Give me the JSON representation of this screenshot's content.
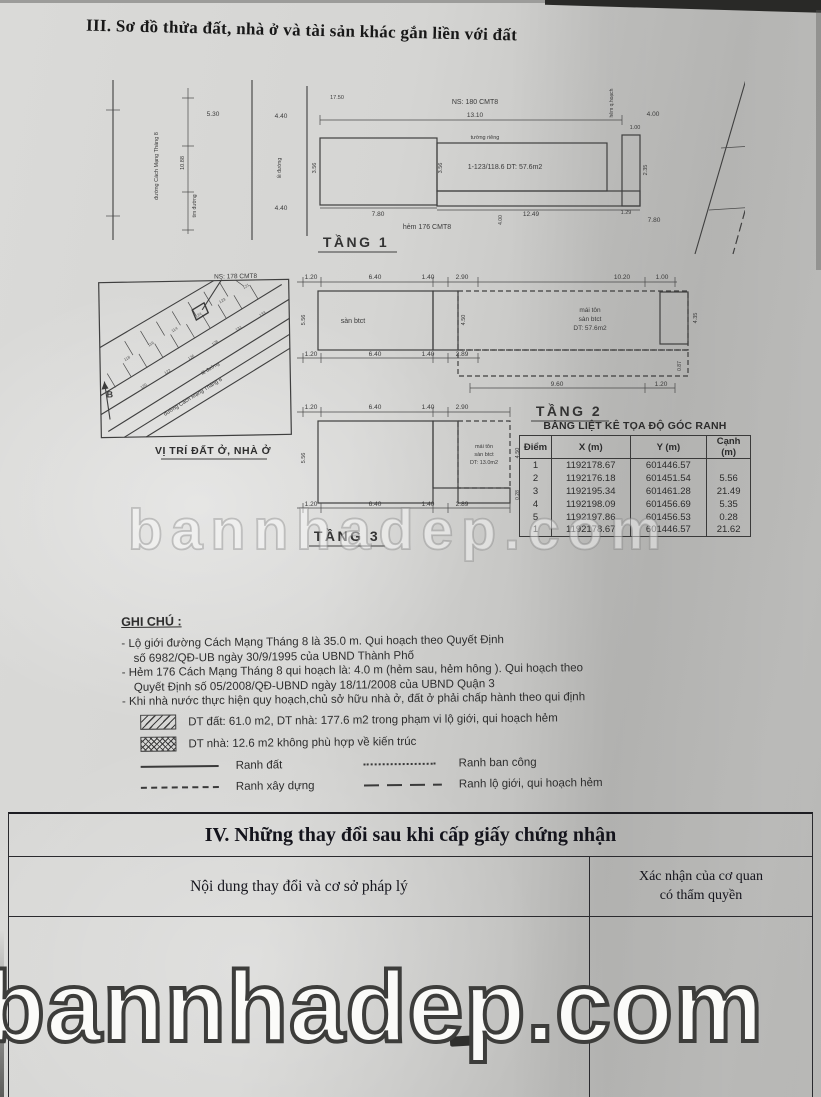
{
  "title3": "III. Sơ đồ thửa đất, nhà ở và tài sản khác gắn liền với đất",
  "watermark": {
    "text": "bannhadep.com"
  },
  "floor1": {
    "label": "TẦNG 1",
    "street": "đường Cách Mạng Tháng 8",
    "tim_duong": "tim đường",
    "le_duong": "lề đường",
    "hem_qh": "hẻm q.hoạch",
    "ns": "NS: 180 CMT8",
    "tuong_rieng": "tường riêng",
    "plot": "1-123/118.6  DT: 57.6m2",
    "hem": "hẻm 176 CMT8",
    "dims": {
      "d530": "5.30",
      "d1088": "10.88",
      "d440a": "4.40",
      "d440b": "4.40",
      "d1750": "17.50",
      "d1310": "13.10",
      "d400": "4.00",
      "d100": "1.00",
      "d356a": "3.56",
      "d356b": "3.56",
      "d235": "2.35",
      "d780a": "7.80",
      "d1249": "12.49",
      "d129": "1.29",
      "d780b": "7.80",
      "d400b": "4.00"
    }
  },
  "floor2": {
    "label": "TẦNG 2",
    "san_btct": "sàn btct",
    "roof_l1": "mái tôn",
    "roof_l2": "sàn btct",
    "roof_l3": "DT: 57.6m2",
    "dims": {
      "t120": "1.20",
      "t640": "6.40",
      "t140": "1.40",
      "t290": "2.90",
      "t1020": "10.20",
      "t100": "1.00",
      "b120": "1.20",
      "b640": "6.40",
      "b140": "1.40",
      "b289": "2.89",
      "b960": "9.60",
      "b120r": "1.20",
      "left": "5.56",
      "mid": "4.50",
      "right": "4.35",
      "small": "0.87"
    }
  },
  "floor3": {
    "label": "TẦNG 3",
    "roof_l1": "mái tôn",
    "roof_l2": "sàn btct",
    "roof_l3": "DT: 13.0m2",
    "dims": {
      "t120": "1.20",
      "t640": "6.40",
      "t140": "1.40",
      "t290": "2.90",
      "b120": "1.20",
      "b640": "6.40",
      "b140": "1.40",
      "b289": "2.89",
      "left": "5.56",
      "right": "4.50",
      "small": "0.28"
    }
  },
  "map": {
    "caption": "VỊ TRÍ ĐẤT Ở, NHÀ Ở",
    "ns": "NS: 178 CMT8",
    "street": "đường Cách Mạng Tháng 8",
    "le_duong": "lề đường",
    "north": "B",
    "parcels": [
      "118",
      "116",
      "114",
      "124",
      "123",
      "121",
      "120",
      "122",
      "126",
      "128",
      "131",
      "133"
    ]
  },
  "coord_table": {
    "title": "BẢNG LIỆT KÊ TỌA ĐỘ GÓC RANH",
    "headers": [
      "Điểm",
      "X (m)",
      "Y (m)",
      "Cạnh (m)"
    ],
    "rows": [
      [
        "1",
        "1192178.67",
        "601446.57",
        ""
      ],
      [
        "2",
        "1192176.18",
        "601451.54",
        "5.56"
      ],
      [
        "3",
        "1192195.34",
        "601461.28",
        "21.49"
      ],
      [
        "4",
        "1192198.09",
        "601456.69",
        "5.35"
      ],
      [
        "5",
        "1192197.86",
        "601456.53",
        "0.28"
      ],
      [
        "1",
        "1192178.67",
        "601446.57",
        "21.62"
      ]
    ]
  },
  "notes": {
    "heading": "GHI CHÚ :",
    "n1a": "- Lộ giới đường Cách Mạng Tháng 8 là 35.0 m. Qui hoạch theo Quyết Định",
    "n1b": "số 6982/QĐ-UB ngày 30/9/1995 của UBND Thành Phố",
    "n2a": "- Hẻm 176 Cách Mạng Tháng 8 qui hoạch là: 4.0 m (hẻm sau, hẻm hông ). Qui hoạch theo",
    "n2b": "Quyết Định số 05/2008/QĐ-UBND ngày 18/11/2008 của UBND Quận 3",
    "n3": "- Khi nhà nước thực hiện quy hoạch,chủ sở hữu nhà ở, đất ở phải chấp hành theo qui định",
    "legend_hatch": "DT đất: 61.0 m2, DT nhà: 177.6 m2 trong phạm vi lộ giới, qui hoạch hẻm",
    "legend_cross": "DT nhà: 12.6 m2 không phù hợp về kiến trúc",
    "ranh_dat": "Ranh đất",
    "ranh_ban_cong": "Ranh ban công",
    "ranh_xay_dung": "Ranh xây dựng",
    "ranh_lo_gioi": "Ranh lộ giới, qui hoạch hẻm"
  },
  "section4": {
    "title": "IV. Những thay đổi sau khi cấp giấy chứng nhận",
    "col1": "Nội dung thay đổi và cơ sở pháp lý",
    "col2a": "Xác nhận của cơ quan",
    "col2b": "có thẩm quyền"
  }
}
